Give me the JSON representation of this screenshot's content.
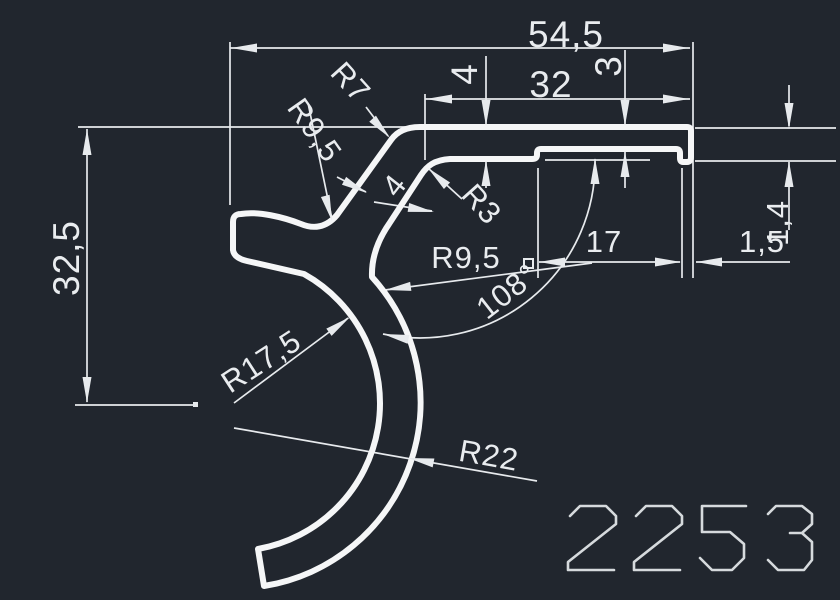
{
  "drawing": {
    "kind": "cad-profile-drawing",
    "part_number": "2253",
    "colors": {
      "background": "#21262e",
      "profile_line": "#f5f6f7",
      "dimension_line": "#e7eaed"
    },
    "dimensions": {
      "total_width": "54,5",
      "top_flange_width": "32",
      "flange_thickness_left": "4",
      "flange_thickness_right": "3",
      "total_height": "32,5",
      "recess_width": "17",
      "lip_width": "1,5",
      "lip_height": "1,4",
      "hook_angle": "108°",
      "fillet_r7": "R7",
      "fillet_r95_outer": "R9,5",
      "neck_thickness": "4",
      "fillet_r3": "R3",
      "fillet_r95_inner": "R9,5",
      "hook_inner_radius": "R17,5",
      "hook_outer_radius": "R22"
    }
  }
}
